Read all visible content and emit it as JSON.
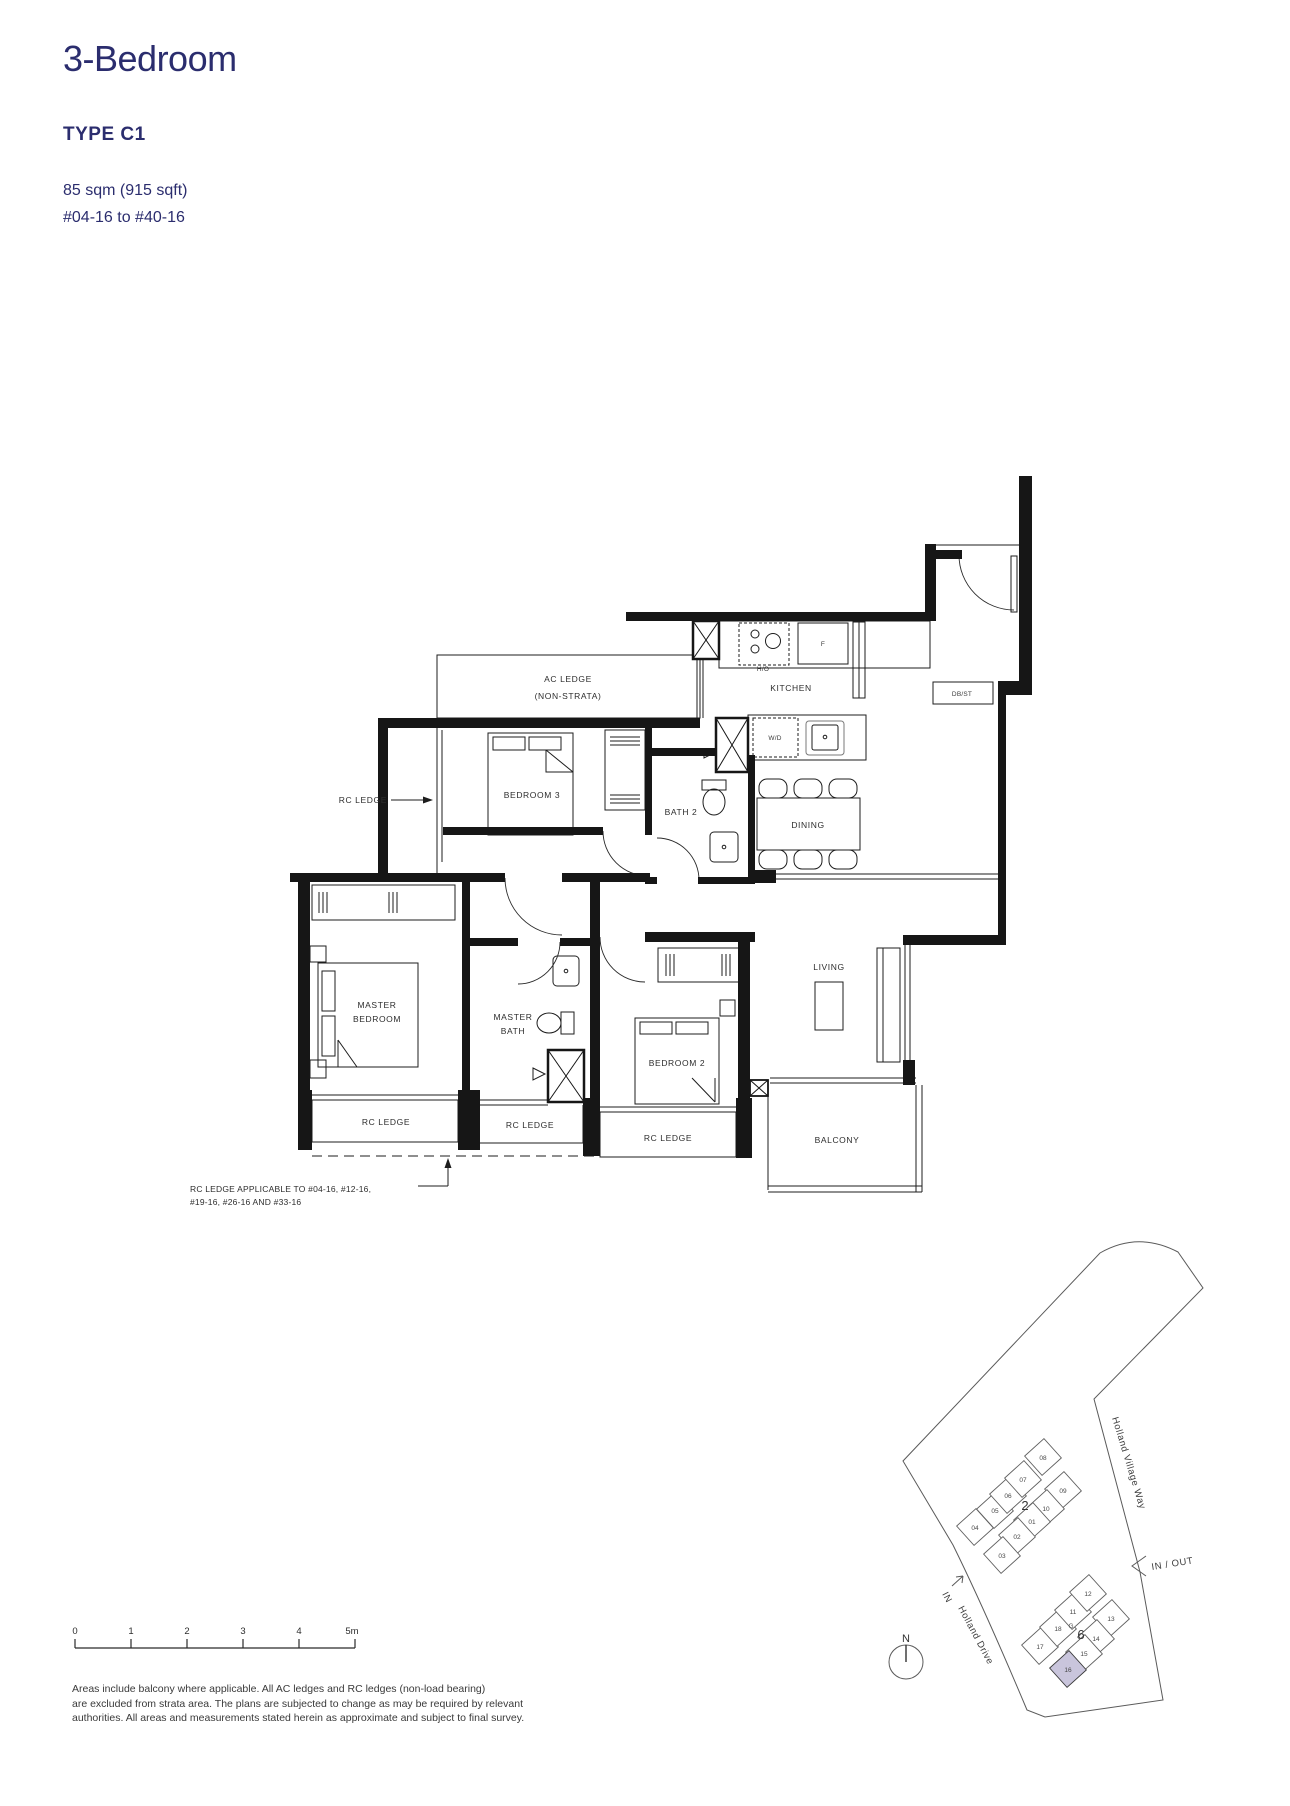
{
  "header": {
    "title": "3-Bedroom",
    "type_label": "TYPE C1",
    "area": "85 sqm (915 sqft)",
    "unit_range": "#04-16 to #40-16"
  },
  "colors": {
    "accent": "#2b2d6e",
    "plan_line": "#1d1d1d",
    "highlight_unit": "#c9c5dc"
  },
  "floorplan": {
    "labels": {
      "ac_ledge_line1": "AC LEDGE",
      "ac_ledge_line2": "(NON-STRATA)",
      "kitchen": "KITCHEN",
      "hob": "H/O",
      "fridge": "F",
      "washer_dryer": "W/D",
      "db_st": "DB/ST",
      "bedroom3": "BEDROOM 3",
      "bath2": "BATH 2",
      "dining": "DINING",
      "living": "LIVING",
      "master_line1": "MASTER",
      "master_line2": "BEDROOM",
      "masterbath_line1": "MASTER",
      "masterbath_line2": "BATH",
      "bedroom2": "BEDROOM 2",
      "balcony": "BALCONY",
      "rc_ledge": "RC LEDGE",
      "note_line1": "RC LEDGE APPLICABLE TO #04-16, #12-16,",
      "note_line2": "#19-16, #26-16 AND #33-16"
    }
  },
  "scalebar": {
    "ticks": [
      "0",
      "1",
      "2",
      "3",
      "4",
      "5m"
    ]
  },
  "sitemap": {
    "road1": "Holland Village Way",
    "road2": "Holland Drive",
    "in_out": "IN / OUT",
    "in_label": "IN",
    "north": "N",
    "guard": "G",
    "cluster2": {
      "label": "2",
      "units": [
        "01",
        "02",
        "03",
        "04",
        "05",
        "06",
        "07",
        "08",
        "09",
        "10"
      ]
    },
    "cluster6": {
      "label": "6",
      "units": [
        "11",
        "12",
        "13",
        "14",
        "15",
        "16",
        "17",
        "18"
      ]
    }
  },
  "footer": {
    "line1": "Areas include balcony where applicable. All AC ledges and RC ledges (non-load bearing)",
    "line2": "are excluded from strata area. The plans are subjected to change as may be required by relevant",
    "line3": "authorities. All areas and measurements stated herein as approximate and subject to final survey."
  }
}
